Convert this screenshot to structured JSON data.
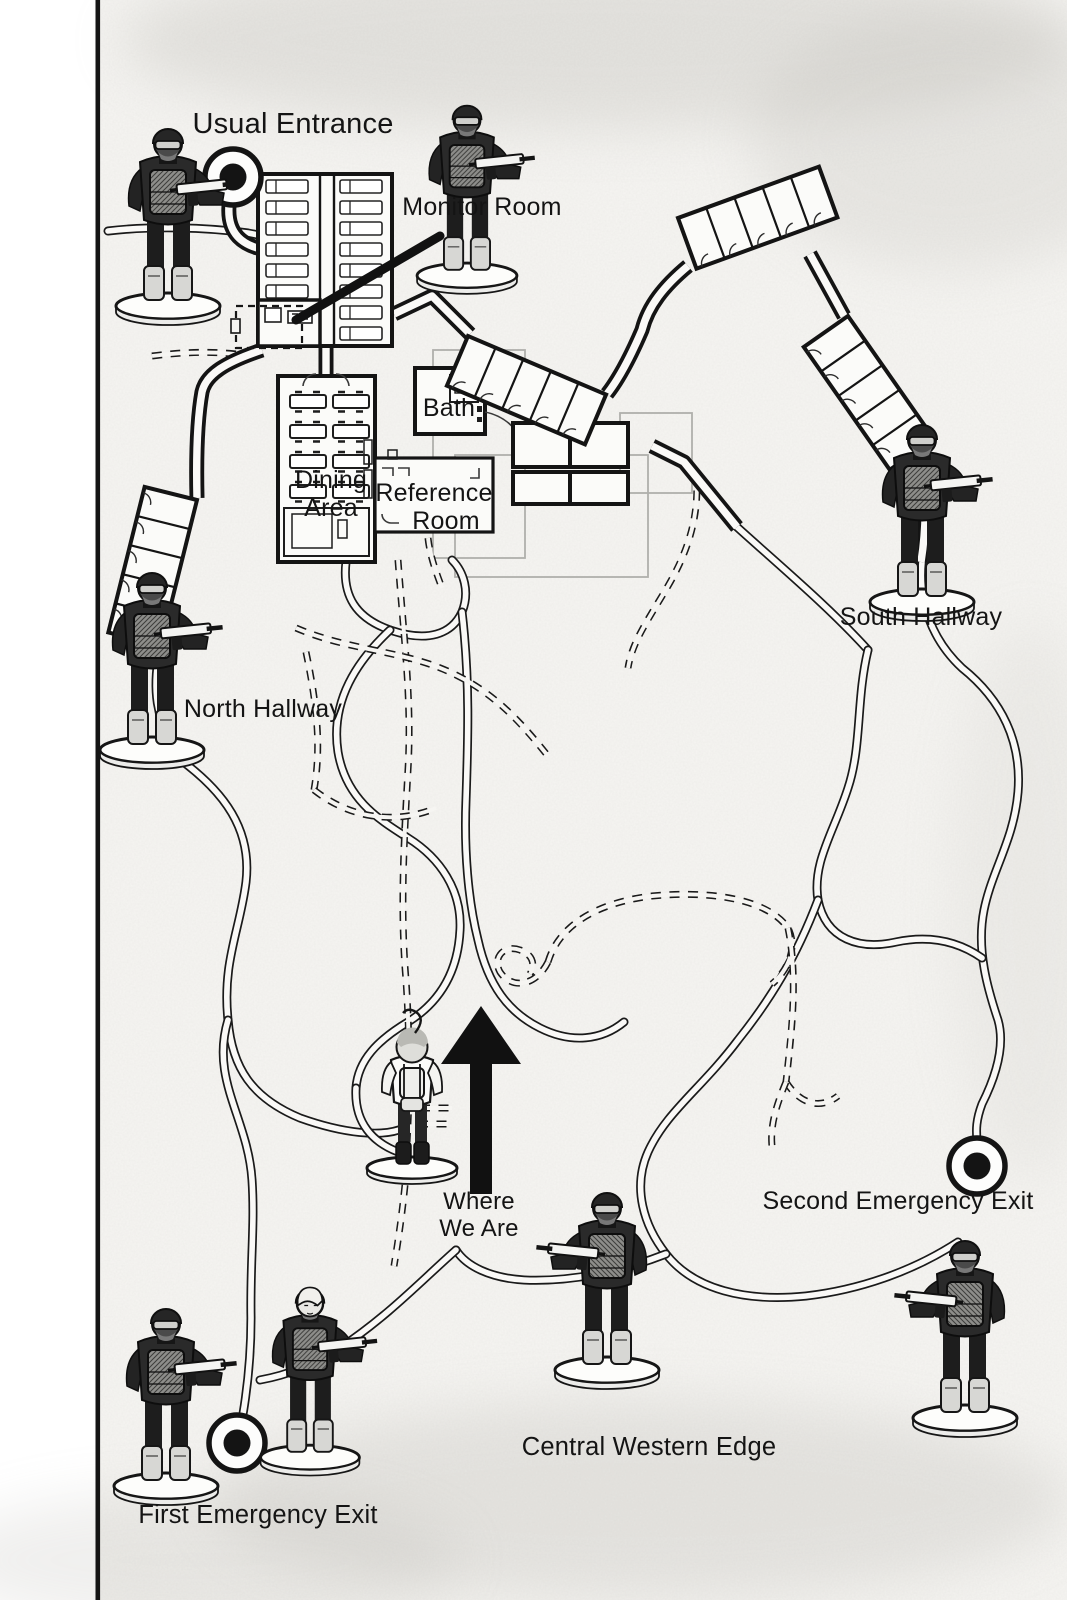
{
  "page": {
    "type": "facility-escape-map",
    "colors": {
      "paper": "#f6f5f2",
      "ink": "#161616",
      "faint_outline": "#b0afac"
    }
  },
  "labels": {
    "usual_entrance": "Usual Entrance",
    "monitor_room": "Monitor Room",
    "bath": "Bath",
    "dining_line1": "Dining",
    "dining_line2": "Area",
    "reference_line1": "Reference",
    "reference_line2": "Room",
    "north_hallway": "North Hallway",
    "south_hallway": "South Hallway",
    "where_line1": "Where",
    "where_line2": "We Are",
    "second_exit": "Second Emergency Exit",
    "central_western_edge": "Central Western Edge",
    "first_exit": "First Emergency Exit"
  },
  "markers": {
    "entrance_marker": "bullseye-icon",
    "first_exit_marker": "bullseye-icon",
    "second_exit_marker": "bullseye-icon",
    "direction_arrow": "up-arrow-icon"
  },
  "figures": {
    "guards": [
      {
        "location": "usual-entrance"
      },
      {
        "location": "monitor-room"
      },
      {
        "location": "north-hallway"
      },
      {
        "location": "south-hallway"
      },
      {
        "location": "central-western-edge"
      },
      {
        "location": "first-emergency-exit-left"
      },
      {
        "location": "first-emergency-exit-right"
      },
      {
        "location": "second-emergency-exit"
      }
    ],
    "child": {
      "location": "where-we-are"
    }
  }
}
